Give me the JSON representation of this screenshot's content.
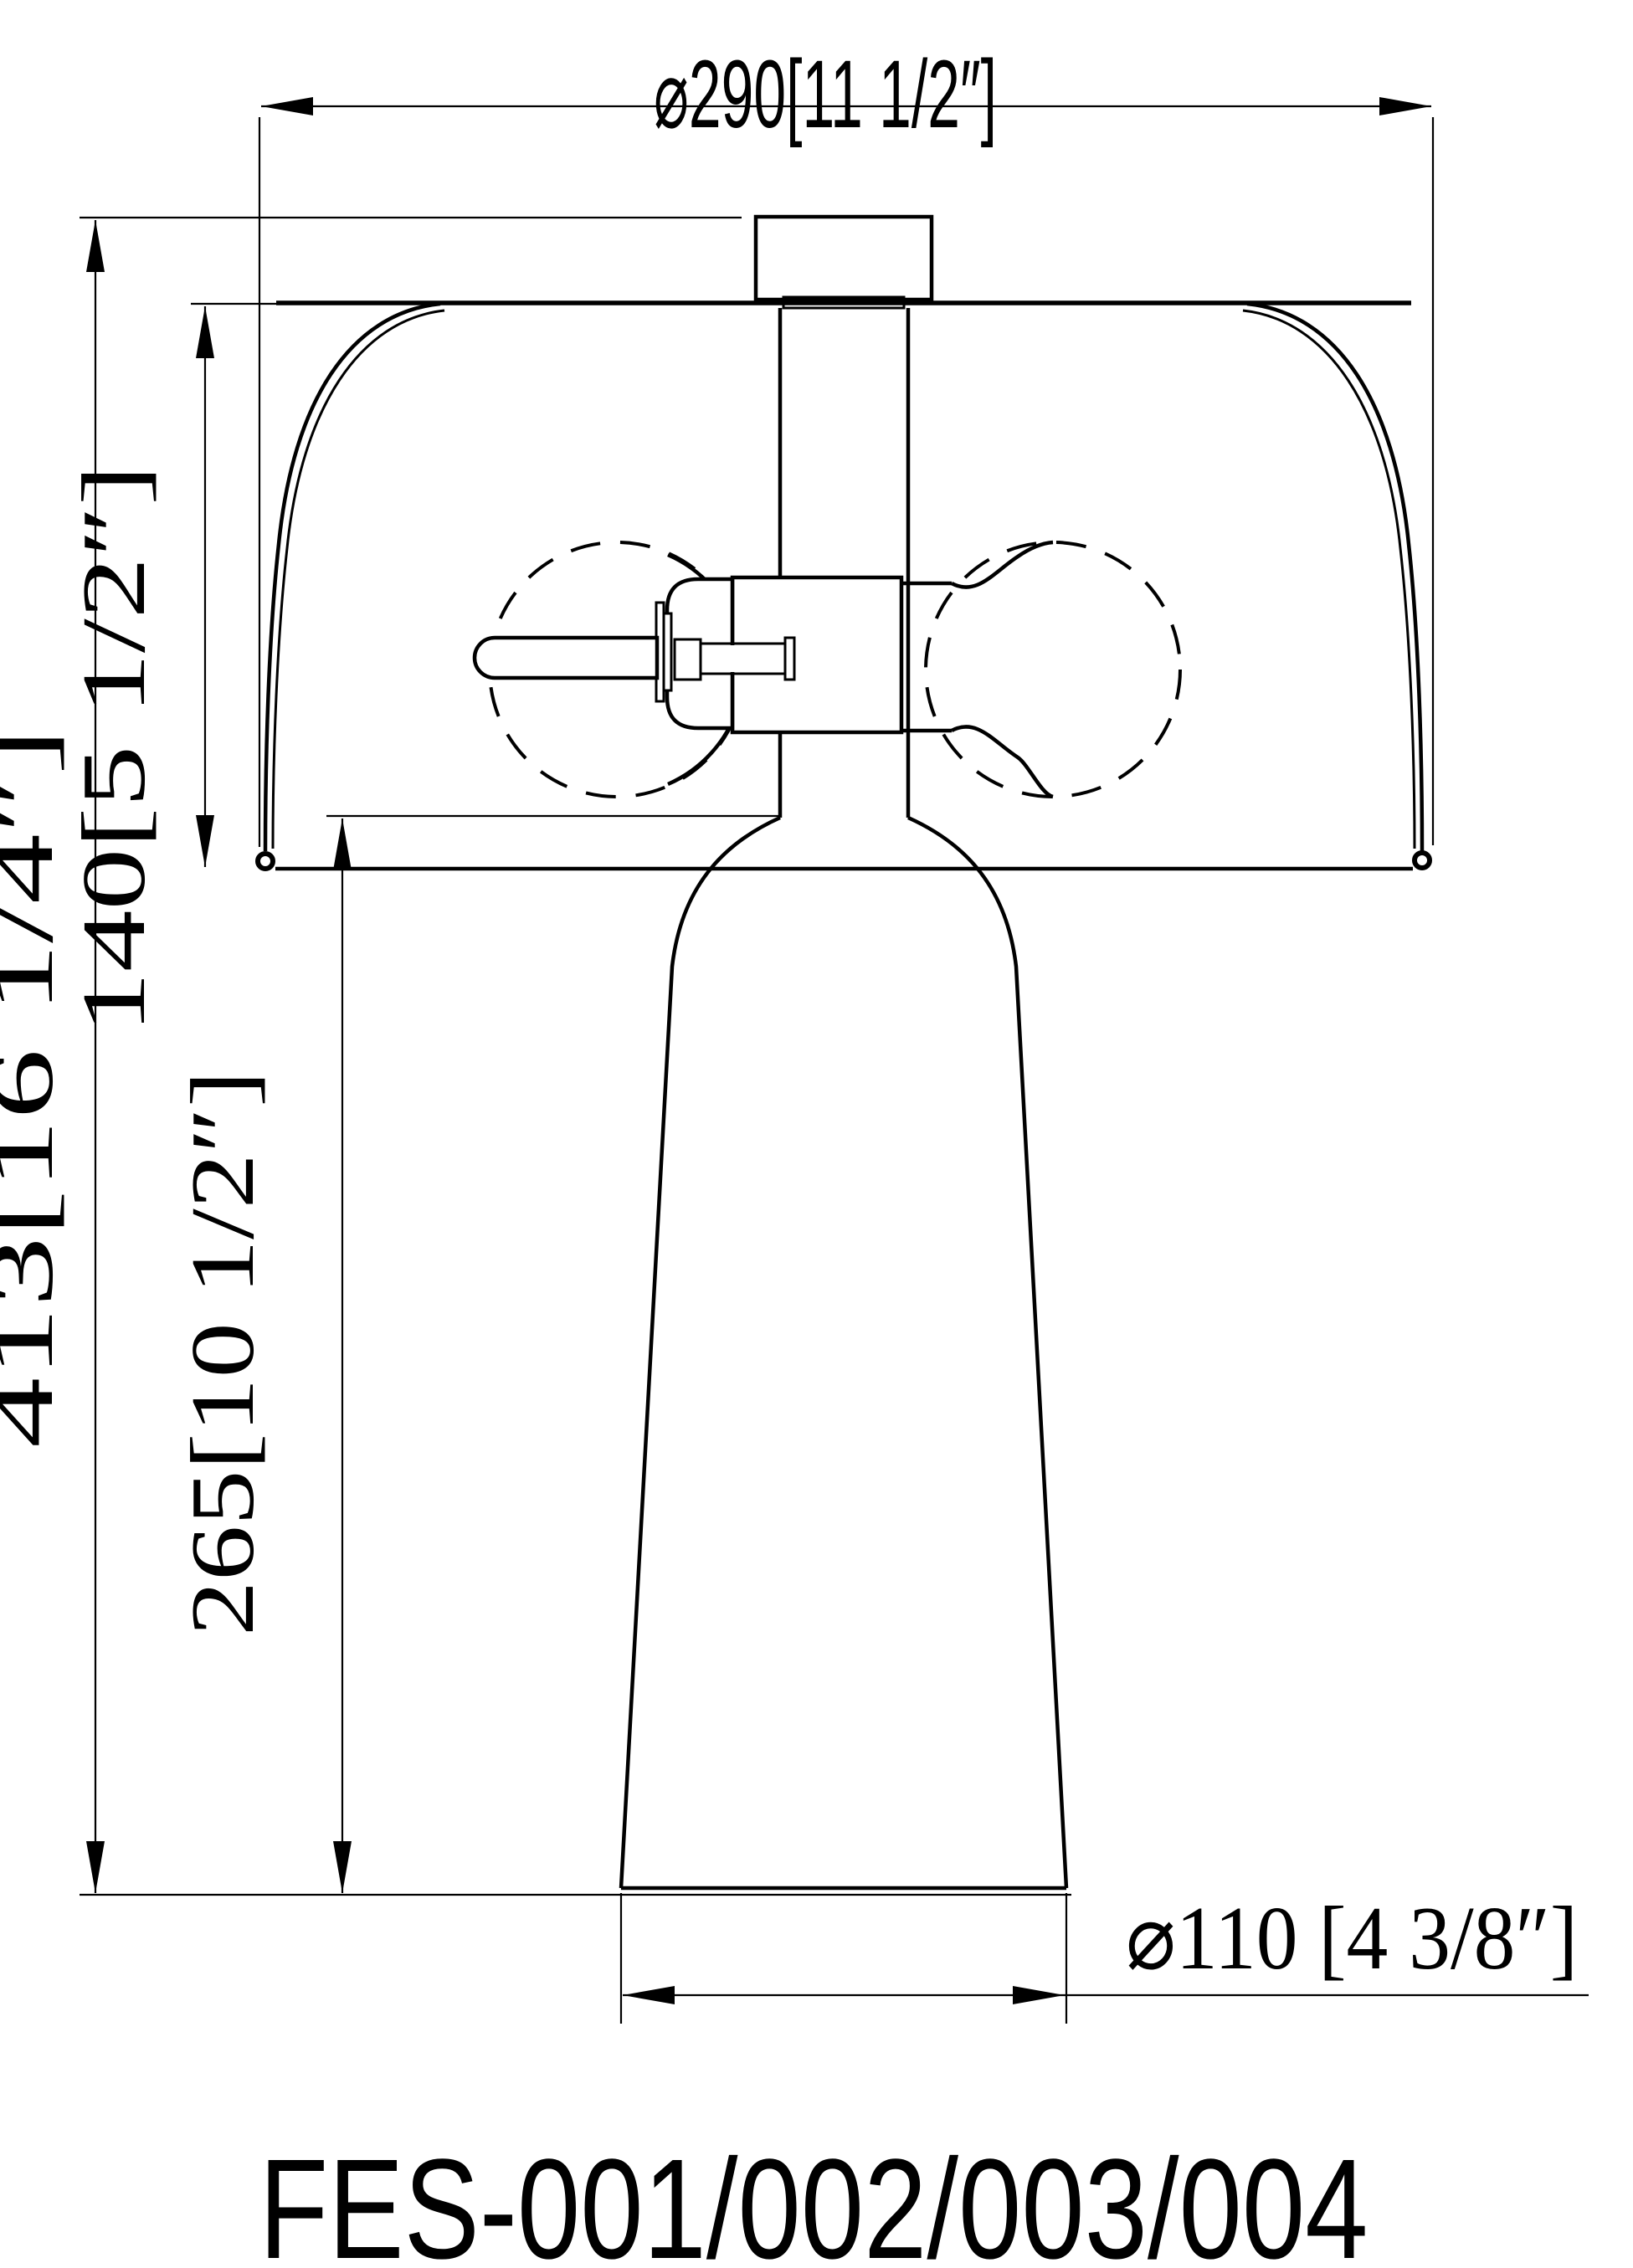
{
  "drawing": {
    "background": "#ffffff",
    "line_color": "#000000",
    "dimensions": {
      "shade_diameter": "⌀290[11 1/2″]",
      "overall_height": "413[16 1/4″]",
      "shade_height": "140[5 1/2″]",
      "base_height": "265[10 1/2″]",
      "base_diameter": "⌀110 [4 3/8″]"
    },
    "model_number": "FES-001/002/003/004"
  }
}
